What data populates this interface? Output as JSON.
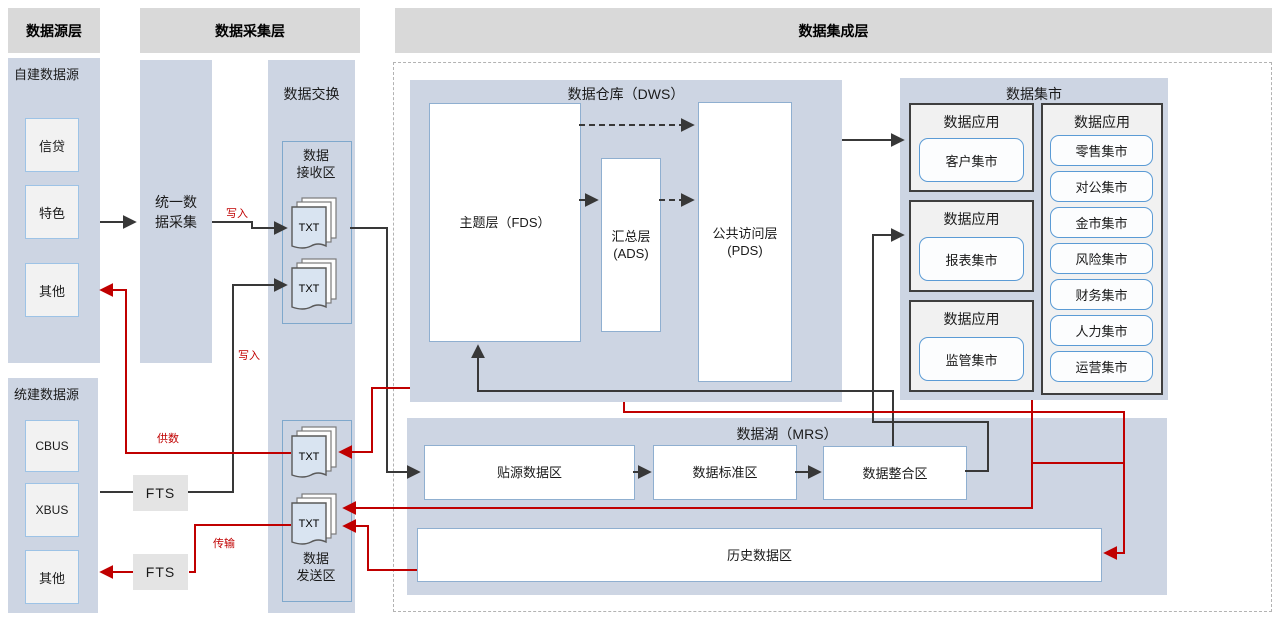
{
  "headers": {
    "source_layer": "数据源层",
    "collection_layer": "数据采集层",
    "integration_layer": "数据集成层"
  },
  "source_layer": {
    "self_built": {
      "title": "自建数据源",
      "items": [
        "信贷",
        "特色",
        "其他"
      ]
    },
    "unified": {
      "title": "统建数据源",
      "items": [
        "CBUS",
        "XBUS",
        "其他"
      ]
    }
  },
  "collection_layer": {
    "unified_collection": {
      "line1": "统一数",
      "line2": "据采集"
    },
    "fts_label": "FTS",
    "exchange": {
      "title": "数据交换",
      "receive": {
        "line1": "数据",
        "line2": "接收区"
      },
      "send": {
        "line1": "数据",
        "line2": "发送区"
      },
      "file_label": "TXT"
    }
  },
  "integration_layer": {
    "dws": {
      "title": "数据仓库（DWS）",
      "fds": "主题层（FDS）",
      "ads": {
        "line1": "汇总层",
        "line2": "(ADS)"
      },
      "pds": {
        "line1": "公共访问层",
        "line2": "(PDS)"
      }
    },
    "mart": {
      "title": "数据集市",
      "app_label": "数据应用",
      "app1": "客户集市",
      "app2": "报表集市",
      "app3": "监管集市",
      "list": [
        "零售集市",
        "对公集市",
        "金市集市",
        "风险集市",
        "财务集市",
        "人力集市",
        "运营集市"
      ]
    },
    "mrs": {
      "title": "数据湖（MRS）",
      "zones": [
        "贴源数据区",
        "数据标准区",
        "数据整合区"
      ],
      "history": "历史数据区"
    }
  },
  "flow_labels": {
    "write1": "写入",
    "write2": "写入",
    "supply": "供数",
    "transfer": "传输"
  },
  "colors": {
    "panel": "#cdd5e3",
    "header": "#d9d9d9",
    "red_flow": "#c00000",
    "black_flow": "#383838",
    "box_border_blue": "#5b9bd5"
  },
  "flows": [
    {
      "from": "自建数据源",
      "to": "统一数据采集",
      "color": "black"
    },
    {
      "from": "统一数据采集",
      "to": "数据接收区",
      "color": "black",
      "label": "写入"
    },
    {
      "from": "CBUS/XBUS",
      "to": "FTS",
      "color": "black"
    },
    {
      "from": "FTS",
      "to": "数据接收区",
      "color": "black",
      "label": "写入"
    },
    {
      "from": "数据接收区",
      "to": "贴源数据区",
      "color": "black"
    },
    {
      "from": "贴源数据区",
      "to": "数据标准区",
      "color": "black"
    },
    {
      "from": "数据标准区",
      "to": "数据整合区",
      "color": "black"
    },
    {
      "from": "数据整合区",
      "to": "主题层（FDS）",
      "color": "black"
    },
    {
      "from": "主题层（FDS）",
      "to": "汇总层（ADS）",
      "color": "black"
    },
    {
      "from": "主题层（FDS）",
      "to": "公共访问层（PDS）",
      "color": "black",
      "style": "dashed"
    },
    {
      "from": "汇总层（ADS）",
      "to": "公共访问层（PDS）",
      "color": "black",
      "style": "dashed"
    },
    {
      "from": "数据仓库（DWS）",
      "to": "客户集市数据应用",
      "color": "black"
    },
    {
      "from": "数据整合区",
      "to": "报表集市数据应用",
      "color": "black"
    },
    {
      "from": "数据仓库（DWS）",
      "to": "数据发送区",
      "color": "red"
    },
    {
      "from": "数据发送区",
      "to": "其他（自建数据源）",
      "color": "red",
      "label": "供数"
    },
    {
      "from": "数据仓库（DWS）",
      "to": "历史数据区",
      "color": "red"
    },
    {
      "from": "数据集市",
      "to": "数据发送区",
      "color": "red"
    },
    {
      "from": "历史数据区",
      "to": "数据发送区",
      "color": "red"
    },
    {
      "from": "数据发送区",
      "to": "FTS",
      "color": "red",
      "label": "传输"
    },
    {
      "from": "FTS",
      "to": "其他（统建数据源）",
      "color": "red"
    }
  ]
}
